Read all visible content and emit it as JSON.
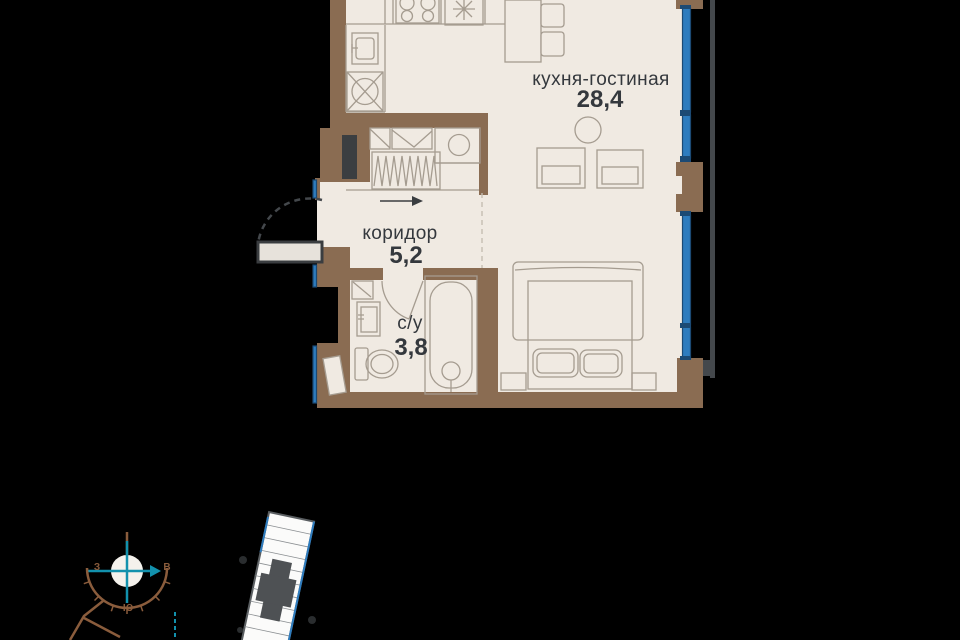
{
  "plan": {
    "rooms": [
      {
        "id": "kitchen-living",
        "name": "кухня-гостиная",
        "area": "28,4"
      },
      {
        "id": "corridor",
        "name": "коридор",
        "area": "5,2"
      },
      {
        "id": "bathroom",
        "name": "с/у",
        "area": "3,8"
      }
    ]
  },
  "compass": {
    "west": "З",
    "east": "В",
    "south": "Ю"
  },
  "colors": {
    "background": "#000000",
    "wall": "#8a6c52",
    "floor": "#f0eae2",
    "window-blue": "#2e7cbe",
    "window-edge": "#1c4a74",
    "fixture": "#a59c90",
    "label": "#34383d",
    "outline": "#44484c",
    "teal": "#1291ad",
    "compass-brown": "#8a5c3c"
  }
}
